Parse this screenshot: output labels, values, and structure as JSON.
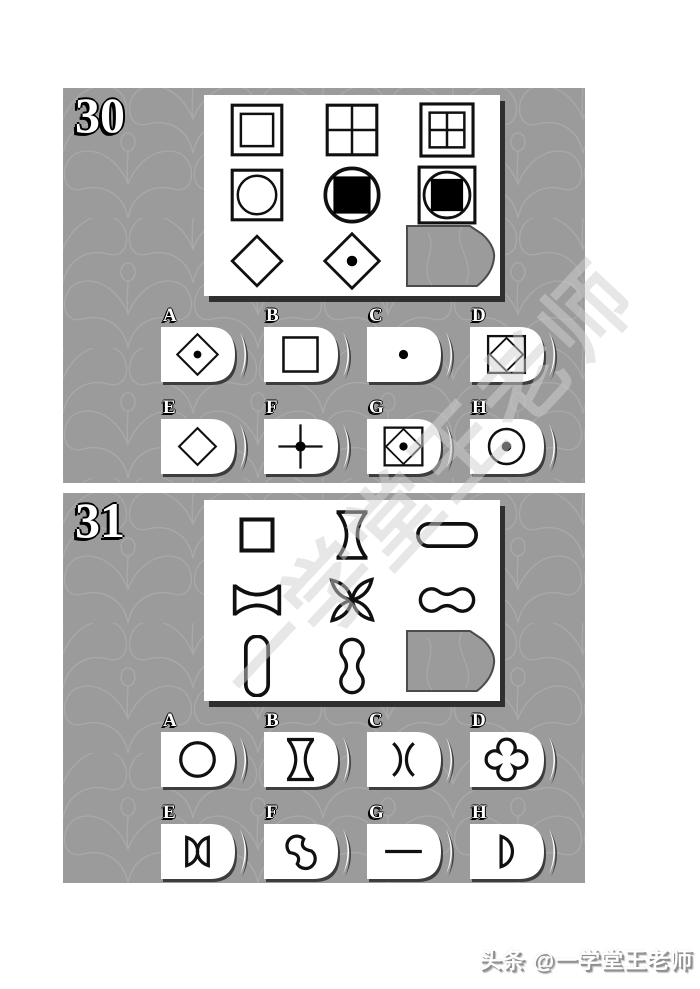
{
  "colors": {
    "panel": "#9b9b9b",
    "shape_stroke": "#101010",
    "tile_shadow": "#2d2d2d"
  },
  "watermark": {
    "text": "一学堂王老师"
  },
  "caption": {
    "text": "头条 @一学堂王老师"
  },
  "questions": [
    {
      "number": "30",
      "matrix": [
        [
          "square-double",
          "square-cross",
          "square-double-cross"
        ],
        [
          "square-circle",
          "circle-blacksquare",
          "square-circle-blacksquare"
        ],
        [
          "diamond",
          "diamond-dot",
          "missing"
        ]
      ],
      "options": [
        {
          "label": "A",
          "shape": "diamond-dot"
        },
        {
          "label": "B",
          "shape": "square"
        },
        {
          "label": "C",
          "shape": "dot"
        },
        {
          "label": "D",
          "shape": "square-diamond"
        },
        {
          "label": "E",
          "shape": "diamond"
        },
        {
          "label": "F",
          "shape": "cross-dot"
        },
        {
          "label": "G",
          "shape": "square-diamond-dot"
        },
        {
          "label": "H",
          "shape": "circle-dot"
        }
      ]
    },
    {
      "number": "31",
      "matrix": [
        [
          "small-square",
          "spool-vertical",
          "capsule-horizontal"
        ],
        [
          "spool-horizontal",
          "four-petal-x",
          "bone-horizontal"
        ],
        [
          "capsule-vertical",
          "bone-vertical",
          "missing"
        ]
      ],
      "options": [
        {
          "label": "A",
          "shape": "circle"
        },
        {
          "label": "B",
          "shape": "spool-vertical"
        },
        {
          "label": "C",
          "shape": "concave-arcs"
        },
        {
          "label": "D",
          "shape": "quatrefoil"
        },
        {
          "label": "E",
          "shape": "bowtie"
        },
        {
          "label": "F",
          "shape": "pinwheel"
        },
        {
          "label": "G",
          "shape": "horizontal-line"
        },
        {
          "label": "H",
          "shape": "half-circle-d"
        }
      ]
    }
  ]
}
